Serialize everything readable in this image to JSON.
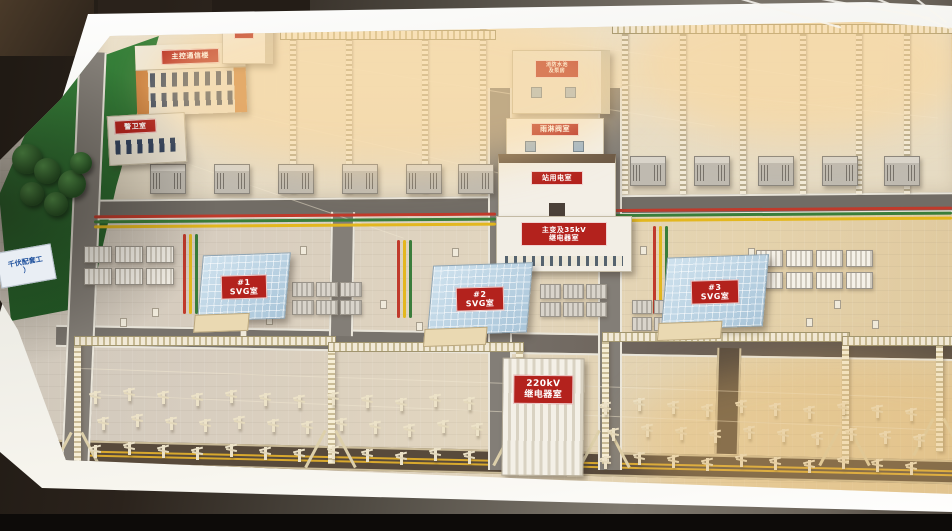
{
  "model": {
    "plate": {
      "line1": "千伏配套工",
      "line2": "）"
    },
    "buildings": {
      "main_control": {
        "label": "主控通信楼"
      },
      "guard": {
        "label": "警卫室"
      },
      "pump": {
        "label": "泵房"
      },
      "fire_pool": {
        "line1": "消防水池",
        "line2": "及泵房"
      },
      "rain_valve": {
        "label": "雨淋阀室"
      },
      "station_power": {
        "label": "站用电室"
      },
      "mv_relay": {
        "line1": "主变及35kV",
        "line2": "继电器室"
      },
      "relay_220kv": {
        "line1": "220kV",
        "line2": "继电器室"
      },
      "svg_1": {
        "line1": "#1",
        "line2": "SVG室"
      },
      "svg_2": {
        "line1": "#2",
        "line2": "SVG室"
      },
      "svg_3": {
        "line1": "#3",
        "line2": "SVG室"
      }
    },
    "colors": {
      "sign_red": "#b3221d",
      "bus_red": "#c03a2b",
      "bus_green": "#3a7d3a",
      "bus_yellow": "#e3b71e",
      "lawn_green": "#2f6e34",
      "table_white": "#f4f1ea"
    }
  }
}
